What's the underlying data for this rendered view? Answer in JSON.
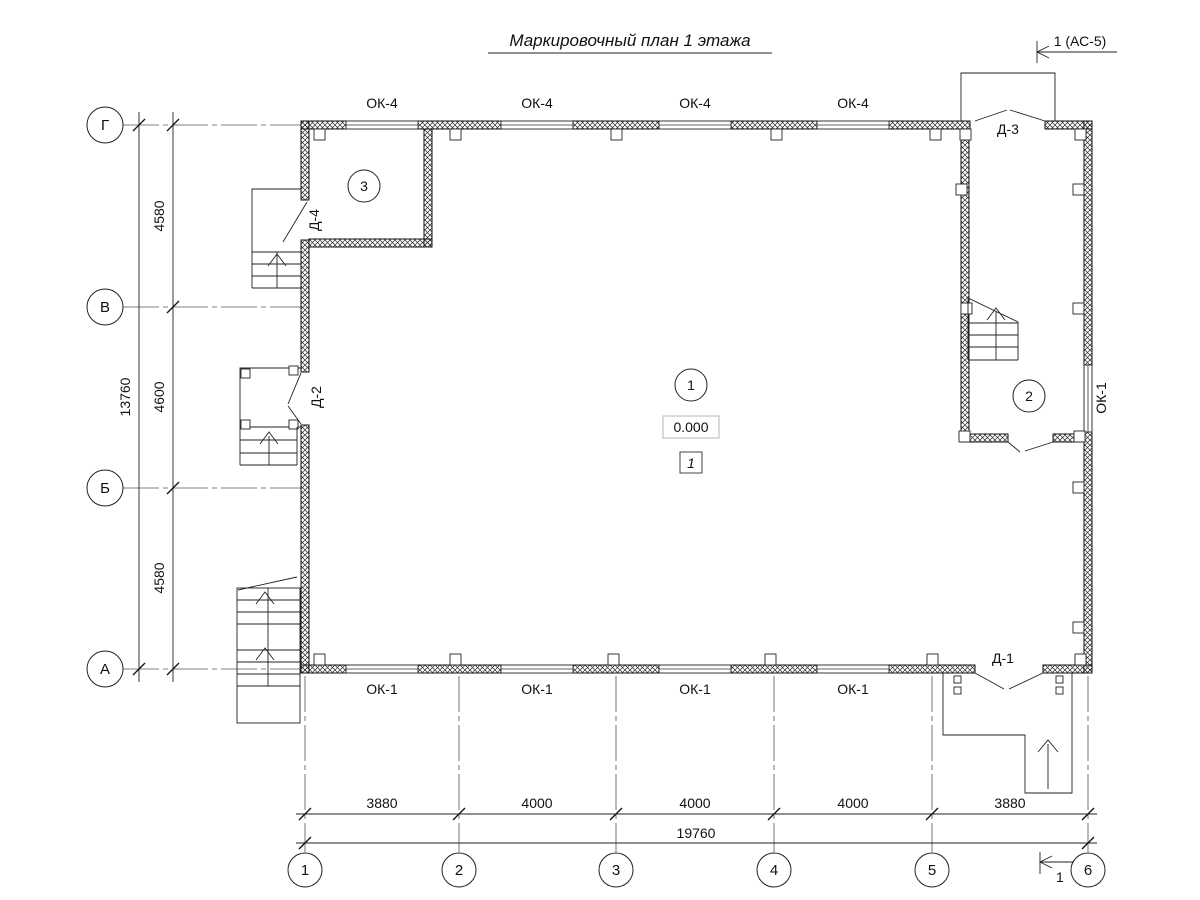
{
  "title": "Маркировочный план 1 этажа",
  "section_markers": {
    "top": "1 (АС-5)",
    "bottom": "1"
  },
  "row_axes": [
    "Г",
    "В",
    "Б",
    "А"
  ],
  "col_axes": [
    "1",
    "2",
    "3",
    "4",
    "5",
    "6"
  ],
  "dims": {
    "left_total": "13760",
    "left_segments": [
      "4580",
      "4600",
      "4580"
    ],
    "bottom_segments": [
      "3880",
      "4000",
      "4000",
      "4000",
      "3880"
    ],
    "bottom_total": "19760"
  },
  "window_labels": {
    "top": [
      "ОК-4",
      "ОК-4",
      "ОК-4",
      "ОК-4"
    ],
    "bottom": [
      "ОК-1",
      "ОК-1",
      "ОК-1",
      "ОК-1"
    ],
    "right": "ОК-1"
  },
  "door_labels": {
    "d1": "Д-1",
    "d2": "Д-2",
    "d3": "Д-3",
    "d4": "Д-4"
  },
  "room_numbers": [
    "1",
    "2",
    "3"
  ],
  "elevation_mark": "0.000",
  "zone_mark": "1",
  "colors": {
    "line": "#111111",
    "background": "#ffffff"
  }
}
